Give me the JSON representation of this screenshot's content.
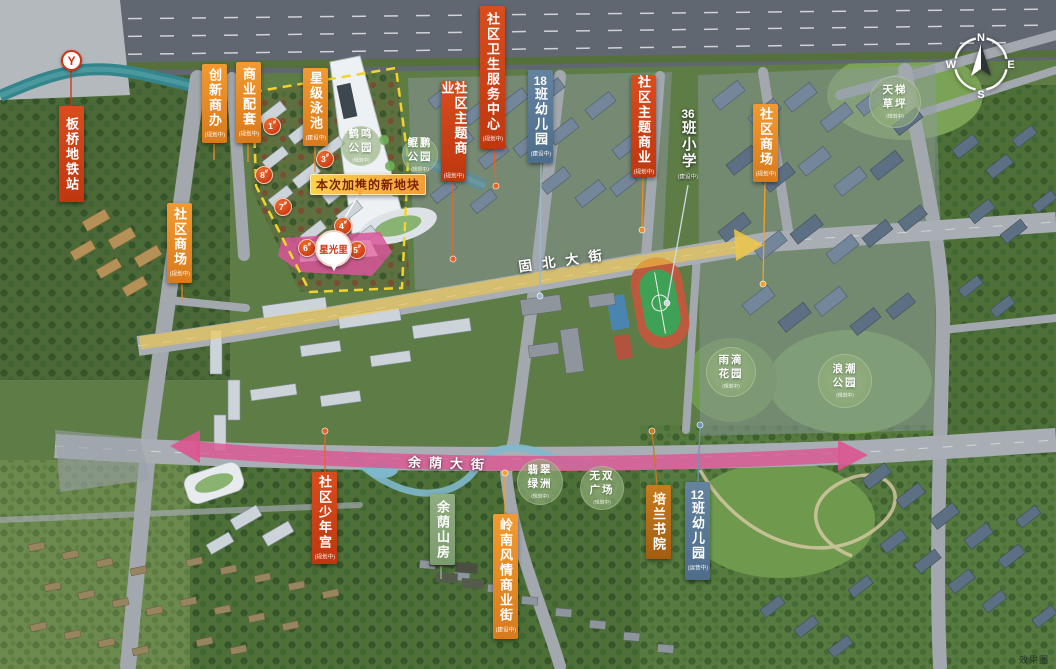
{
  "watermark": "效果图",
  "roads": {
    "guibei": "固北大街",
    "yuyin": "余荫大街"
  },
  "banner": {
    "text": "本次加推的新地块"
  },
  "pin": {
    "name": "星光里"
  },
  "metro": {
    "glyph": "Y"
  },
  "compass": {
    "n": "N",
    "e": "E",
    "s": "S",
    "w": "W"
  },
  "colors": {
    "red_label": "#d14a1c",
    "orange_label": "#e8882a",
    "blue_label": "#5a7c9b",
    "sage_label": "#8aa87c",
    "plot_boundary": "#f2d32c",
    "plot_highlight": "#d9569a",
    "yuyin_overlay": "#de528f",
    "guibei_overlay": "#eec53c"
  },
  "labels": [
    {
      "id": "banqiao-metro-station",
      "text": "板桥地铁站",
      "sub": "",
      "style": "red",
      "x": 59,
      "y": 106,
      "h": 96,
      "icon": "metro"
    },
    {
      "id": "chuangxin-shangban",
      "text": "创新商办",
      "sub": "(规划中)",
      "style": "orange",
      "x": 202,
      "y": 64,
      "h": 79
    },
    {
      "id": "shangye-peitao",
      "text": "商业配套",
      "sub": "(规划中)",
      "style": "orange",
      "x": 236,
      "y": 62,
      "h": 81
    },
    {
      "id": "xingji-yongchi",
      "text": "星级泳池",
      "sub": "(建设中)",
      "style": "orange",
      "x": 303,
      "y": 68,
      "h": 78
    },
    {
      "id": "shequ-shangchang-west",
      "text": "社区商场",
      "sub": "(规划中)",
      "style": "orange",
      "x": 167,
      "y": 203,
      "h": 80
    },
    {
      "id": "shequ-zhuti-shangye-west",
      "text": "社区主题商业",
      "sub": "(规划中)",
      "style": "red",
      "x": 441,
      "y": 81,
      "h": 100
    },
    {
      "id": "shequ-weisheng-fuwu-zhongxin",
      "text": "社区卫生服务中心",
      "sub": "(规划中)",
      "style": "red",
      "x": 480,
      "y": 6,
      "h": 143
    },
    {
      "id": "youeryuan-18ban",
      "text": "18班幼儿园",
      "sub": "(建设中)",
      "style": "blue",
      "x": 528,
      "y": 70,
      "h": 93
    },
    {
      "id": "shequ-zhuti-shangye-east",
      "text": "社区主题商业",
      "sub": "(规划中)",
      "style": "red",
      "x": 631,
      "y": 75,
      "h": 102
    },
    {
      "id": "xiaoxue-36ban",
      "text": "36班小学",
      "sub": "(建设中)",
      "style": "plain",
      "x": 675,
      "y": 106,
      "h": 78
    },
    {
      "id": "shequ-shangchang-east",
      "text": "社区商场",
      "sub": "(规划中)",
      "style": "orange",
      "x": 753,
      "y": 104,
      "h": 78
    },
    {
      "id": "shequ-shaoniangong",
      "text": "社区少年宫",
      "sub": "(规划中)",
      "style": "red",
      "x": 312,
      "y": 472,
      "h": 92
    },
    {
      "id": "yuyin-shanfang",
      "text": "余荫山房",
      "sub": "",
      "style": "green",
      "x": 430,
      "y": 494,
      "h": 71
    },
    {
      "id": "lingnan-fengqing-shangyejie",
      "text": "岭南风情商业街",
      "sub": "(建设中)",
      "style": "orange",
      "x": 493,
      "y": 514,
      "h": 125
    },
    {
      "id": "peilan-shuyuan",
      "text": "培兰书院",
      "sub": "",
      "style": "darkorange",
      "x": 646,
      "y": 485,
      "h": 74
    },
    {
      "id": "youeryuan-12ban",
      "text": "12班幼儿园",
      "sub": "(运营中)",
      "style": "blue",
      "x": 685,
      "y": 482,
      "h": 98
    }
  ],
  "parks": [
    {
      "id": "heming-park",
      "line1": "鹤鸣",
      "line2": "公园",
      "sub": "(规划中)",
      "cx": 361,
      "cy": 146,
      "d": 40
    },
    {
      "id": "kunpeng-park",
      "line1": "鲲鹏",
      "line2": "公园",
      "sub": "(规划中)",
      "cx": 420,
      "cy": 155,
      "d": 36
    },
    {
      "id": "tianti-lawn",
      "line1": "天梯",
      "line2": "草坪",
      "sub": "(规划中)",
      "cx": 895,
      "cy": 102,
      "d": 52
    },
    {
      "id": "yudi-garden",
      "line1": "雨滴",
      "line2": "花园",
      "sub": "(规划中)",
      "cx": 731,
      "cy": 372,
      "d": 50
    },
    {
      "id": "langchao-park",
      "line1": "浪潮",
      "line2": "公园",
      "sub": "(规划中)",
      "cx": 845,
      "cy": 381,
      "d": 54
    },
    {
      "id": "feicui-oasis",
      "line1": "翡翠",
      "line2": "绿洲",
      "sub": "(规划中)",
      "cx": 540,
      "cy": 482,
      "d": 46
    },
    {
      "id": "wushuang-plaza",
      "line1": "无双",
      "line2": "广场",
      "sub": "(规划中)",
      "cx": 602,
      "cy": 488,
      "d": 44
    }
  ],
  "badges": [
    {
      "label": "1#",
      "x": 271,
      "y": 125
    },
    {
      "label": "3#",
      "x": 324,
      "y": 158
    },
    {
      "label": "8#",
      "x": 263,
      "y": 174
    },
    {
      "label": "7#",
      "x": 282,
      "y": 206
    },
    {
      "label": "4#",
      "x": 342,
      "y": 225
    },
    {
      "label": "6#",
      "x": 306,
      "y": 247
    },
    {
      "label": "5#",
      "x": 356,
      "y": 249
    }
  ],
  "connectors": [
    {
      "x1": 71,
      "y1": 70,
      "x2": 71,
      "y2": 106,
      "c": "#d3310f",
      "dot": false
    },
    {
      "x1": 214,
      "y1": 144,
      "x2": 214,
      "y2": 160,
      "c": "#f08a28",
      "dot": false
    },
    {
      "x1": 248,
      "y1": 144,
      "x2": 248,
      "y2": 162,
      "c": "#f08a28",
      "dot": false
    },
    {
      "x1": 315,
      "y1": 147,
      "x2": 315,
      "y2": 172,
      "c": "#f08a28",
      "dot": false
    },
    {
      "x1": 182,
      "y1": 284,
      "x2": 182,
      "y2": 301,
      "c": "#f08a28",
      "dot": false
    },
    {
      "x1": 453,
      "y1": 182,
      "x2": 453,
      "y2": 259,
      "c": "#e8622a",
      "dot": true
    },
    {
      "x1": 494,
      "y1": 150,
      "x2": 496,
      "y2": 186,
      "c": "#e8622a",
      "dot": true
    },
    {
      "x1": 541,
      "y1": 164,
      "x2": 540,
      "y2": 296,
      "c": "#9db8cf",
      "dot": true
    },
    {
      "x1": 643,
      "y1": 178,
      "x2": 642,
      "y2": 230,
      "c": "#f08a28",
      "dot": true
    },
    {
      "x1": 688,
      "y1": 185,
      "x2": 667,
      "y2": 303,
      "c": "#cfd9e2",
      "dot": true
    },
    {
      "x1": 765,
      "y1": 183,
      "x2": 763,
      "y2": 284,
      "c": "#f0a22c",
      "dot": true
    },
    {
      "x1": 325,
      "y1": 472,
      "x2": 325,
      "y2": 431,
      "c": "#e8622a",
      "dot": true
    },
    {
      "x1": 441,
      "y1": 566,
      "x2": 441,
      "y2": 579,
      "c": "#9cb890",
      "dot": false
    },
    {
      "x1": 505,
      "y1": 514,
      "x2": 505,
      "y2": 473,
      "c": "#f0a22c",
      "dot": true
    },
    {
      "x1": 657,
      "y1": 485,
      "x2": 652,
      "y2": 431,
      "c": "#c9791e",
      "dot": true
    },
    {
      "x1": 698,
      "y1": 482,
      "x2": 700,
      "y2": 425,
      "c": "#6e93b5",
      "dot": true
    },
    {
      "x1": 358,
      "y1": 196,
      "x2": 337,
      "y2": 231,
      "c": "#ffffff",
      "dot": false
    }
  ]
}
